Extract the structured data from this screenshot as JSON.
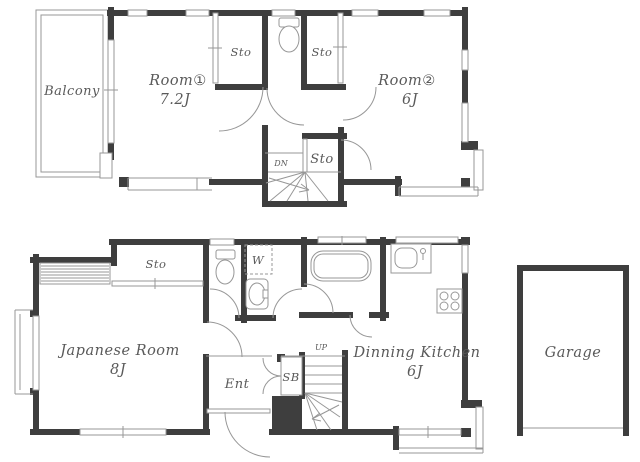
{
  "colors": {
    "wall": "#3e3e3e",
    "thin_line": "#979797",
    "text": "#5a5a5a"
  },
  "floor2": {
    "balcony": "Balcony",
    "room1_name": "Room①",
    "room1_area": "7.2J",
    "room2_name": "Room②",
    "room2_area": "6J",
    "storage_left": "Sto",
    "storage_right": "Sto",
    "storage_hall": "Sto",
    "stairs_label": "DN"
  },
  "floor1": {
    "storage": "Sto",
    "japanese_room_name": "Japanese Room",
    "japanese_room_area": "8J",
    "washer": "W",
    "entrance": "Ent",
    "shoe_cabinet": "SB",
    "stairs_label": "UP",
    "dining_kitchen_name": "Dinning Kitchen",
    "dining_kitchen_area": "6J",
    "garage": "Garage"
  }
}
